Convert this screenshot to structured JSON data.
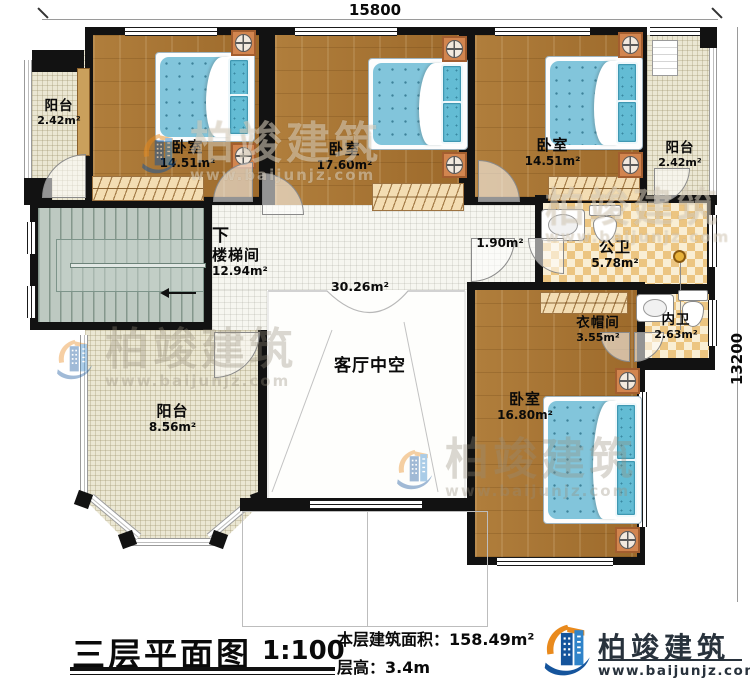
{
  "dimensions": {
    "top": "15800",
    "right": "13200"
  },
  "rooms": {
    "balcony_tl": {
      "name": "阳台",
      "area": "2.42m²"
    },
    "bedroom1": {
      "name": "卧室",
      "area": "14.51m²"
    },
    "bedroom2": {
      "name": "卧室",
      "area": "17.60m²"
    },
    "bedroom3": {
      "name": "卧室",
      "area": "14.51m²"
    },
    "balcony_tr": {
      "name": "阳台",
      "area": "2.42m²"
    },
    "stairwell": {
      "down": "下",
      "name": "楼梯间",
      "area": "12.94m²"
    },
    "corridor": {
      "area": "1.90m²"
    },
    "hall": {
      "area": "30.26m²"
    },
    "public_bath": {
      "name": "公卫",
      "area": "5.78m²"
    },
    "closet": {
      "name": "衣帽间",
      "area": "3.55m²"
    },
    "inner_bath": {
      "name": "内卫",
      "area": "2.63m²"
    },
    "bedroom4": {
      "name": "卧室",
      "area": "16.80m²"
    },
    "balcony_bl": {
      "name": "阳台",
      "area": "8.56m²"
    },
    "void": {
      "name": "客厅中空"
    }
  },
  "title_block": {
    "title": "三层平面图",
    "scale": "1:100",
    "area_label": "本层建筑面积：",
    "area_value": "158.49m²",
    "floor_height_label": "层高：",
    "floor_height_value": "3.4m"
  },
  "logo": {
    "name": "柏竣建筑",
    "website": "www.baijunjz.com"
  },
  "watermark": {
    "name": "柏竣建筑",
    "website": "www.baijunjz.com"
  },
  "colors": {
    "wall": "#121212",
    "wood_floor": "#a9752f",
    "balcony_tile": "#ebe7d3",
    "bath_checker": "#ecc581",
    "stair_floor": "#bdc9c1",
    "bed_blue": "#82c5db",
    "brand_blue": "#15549c",
    "brand_orange": "#e98a1d"
  }
}
